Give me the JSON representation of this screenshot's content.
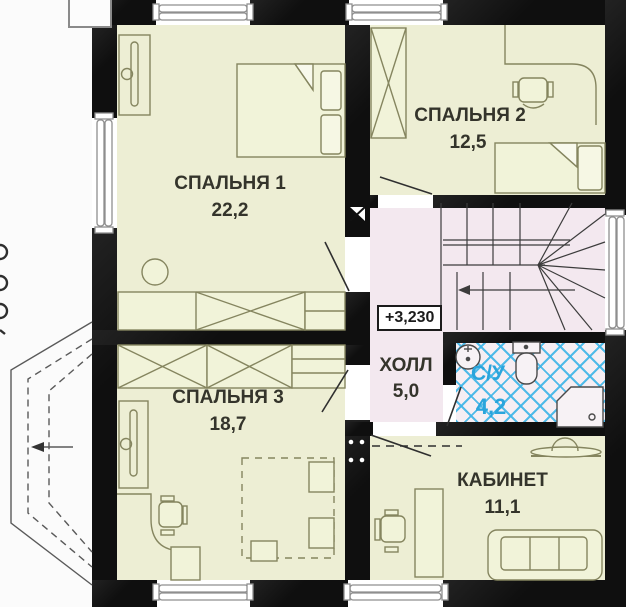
{
  "floor_plan": {
    "rooms": [
      {
        "name": "СПАЛЬНЯ 1",
        "area": "22,2"
      },
      {
        "name": "СПАЛЬНЯ 2",
        "area": "12,5"
      },
      {
        "name": "СПАЛЬНЯ 3",
        "area": "18,7"
      },
      {
        "name": "ХОЛЛ",
        "area": "5,0"
      },
      {
        "name": "С/У",
        "area": "4,2"
      },
      {
        "name": "КАБИНЕТ",
        "area": "11,1"
      }
    ],
    "elevation_mark": "+3,230",
    "colors": {
      "room_fill": "#edeed4",
      "hall_fill": "#f3e8ef",
      "bathroom_tile": "#3eb5e7",
      "bathroom_text": "#2aa5dc",
      "wall": "#0f0f0f"
    }
  }
}
